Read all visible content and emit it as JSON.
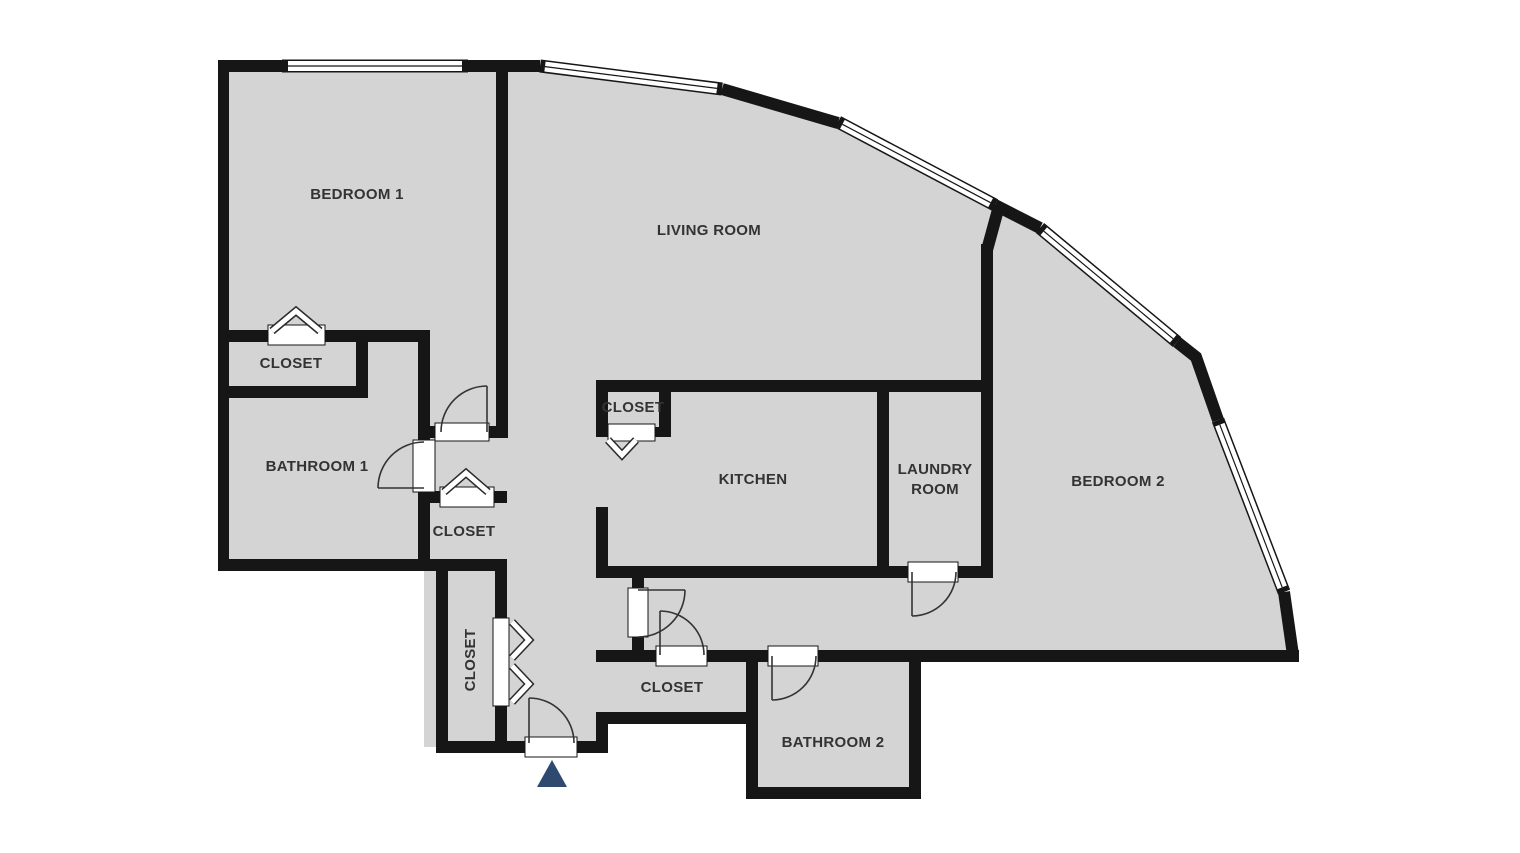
{
  "floorplan": {
    "rooms": {
      "bedroom1": {
        "label": "BEDROOM 1"
      },
      "living": {
        "label": "LIVING ROOM"
      },
      "closet1": {
        "label": "CLOSET"
      },
      "bathroom1": {
        "label": "BATHROOM 1"
      },
      "closet2": {
        "label": "CLOSET"
      },
      "closet3": {
        "label": "CLOSET"
      },
      "kitchen": {
        "label": "KITCHEN"
      },
      "laundry": {
        "label_line1": "LAUNDRY",
        "label_line2": "ROOM"
      },
      "bedroom2": {
        "label": "BEDROOM 2"
      },
      "closet4": {
        "label": "CLOSET"
      },
      "closet_hall": {
        "label": "CLOSET"
      },
      "bathroom2": {
        "label": "BATHROOM 2"
      }
    },
    "markers": {
      "entrance_icon": "entrance-arrow"
    },
    "colors": {
      "background": "#ffffff",
      "floor_fill": "#d4d4d4",
      "wall": "#161616",
      "window_fill": "#ffffff",
      "door_arc": "#333333",
      "label_text": "#333333",
      "entrance_marker": "#2e4a6e"
    }
  }
}
